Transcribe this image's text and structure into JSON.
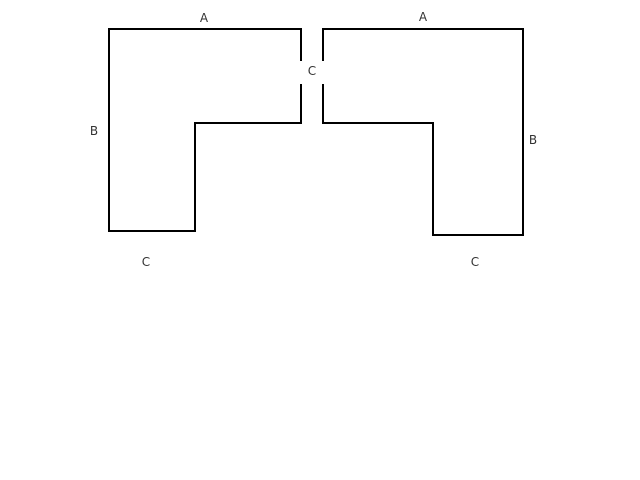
{
  "diagram": {
    "title": "two-mirrored-l-shapes-with-labeled-sides",
    "background": "#ffffff",
    "stroke_color": "#000000",
    "stroke_width": 2,
    "label_color": "#333333",
    "label_font_size": 12,
    "canvas": {
      "width": 640,
      "height": 480
    },
    "shapes": [
      {
        "name": "left-l-shape-outline",
        "points": "301,61 301,29 109,29 109,231 195,231 195,123 301,123 301,84"
      },
      {
        "name": "right-l-shape-outline",
        "points": "323,61 323,29 523,29 523,235 433,235 433,123 323,123 323,84"
      }
    ],
    "labels": [
      {
        "name": "label-a-left-top-side",
        "text": "A",
        "x": 204,
        "y": 22
      },
      {
        "name": "label-a-right-top-side",
        "text": "A",
        "x": 423,
        "y": 21
      },
      {
        "name": "label-b-left-side",
        "text": "B",
        "x": 94,
        "y": 135
      },
      {
        "name": "label-b-right-side",
        "text": "B",
        "x": 533,
        "y": 144
      },
      {
        "name": "label-c-center-gap",
        "text": "C",
        "x": 312,
        "y": 75
      },
      {
        "name": "label-c-left-bottom-side",
        "text": "C",
        "x": 146,
        "y": 266
      },
      {
        "name": "label-c-right-bottom-side",
        "text": "C",
        "x": 475,
        "y": 266
      }
    ]
  }
}
